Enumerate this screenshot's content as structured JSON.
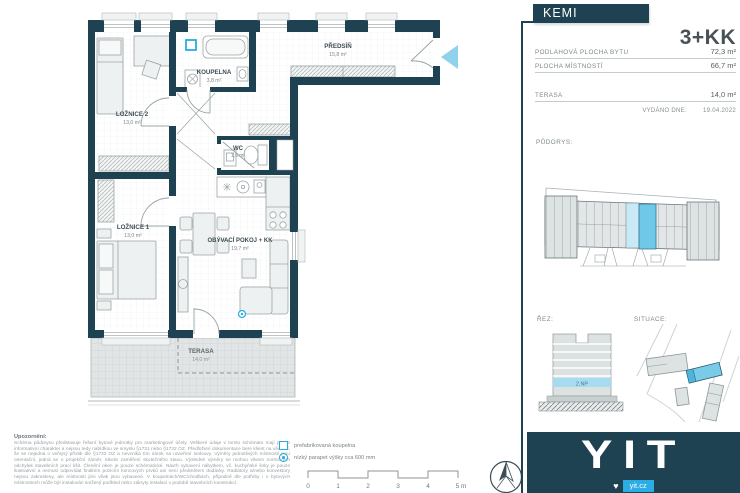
{
  "project": {
    "name": "KEMI",
    "unit_type": "3+KK"
  },
  "info": {
    "rows": [
      {
        "label": "PODLAHOVÁ PLOCHA BYTU",
        "value": "72,3 m²"
      },
      {
        "label": "PLOCHA MÍSTNOSTÍ",
        "value": "66,7 m²"
      },
      {
        "label": "TERASA",
        "value": "14,0 m²"
      }
    ],
    "issued_label": "VYDÁNO DNE:",
    "issued_date": "19.04.2022"
  },
  "section_labels": {
    "floorplan": "PŮDORYS:",
    "cut": "ŘEZ:",
    "situation": "SITUACE:"
  },
  "building": {
    "floor_badge": "2.NP"
  },
  "rooms": [
    {
      "name": "LOŽNICE 2",
      "area": "13,0 m²"
    },
    {
      "name": "KOUPELNA",
      "area": "3,8 m²"
    },
    {
      "name": "PŘEDSÍŇ",
      "area": "15,8 m²"
    },
    {
      "name": "WC",
      "area": "1,6 m²"
    },
    {
      "name": "LOŽNICE 1",
      "area": "13,0 m²"
    },
    {
      "name": "OBÝVACÍ POKOJ + KK",
      "area": "19,7 m²"
    },
    {
      "name": "TERASA",
      "area": "14,0 m²"
    }
  ],
  "legend": {
    "items": [
      {
        "label": "prefabrikovaná koupelna"
      },
      {
        "label": "nízký parapet výšky cca 600 mm"
      }
    ]
  },
  "scale_bar": {
    "ticks": [
      "0",
      "1",
      "2",
      "3",
      "4",
      "5 m"
    ]
  },
  "disclaimer": {
    "title": "Upozornění:",
    "body": "Schéma půdorysu představuje řešení bytové jednotky pro marketingové účely. Veškeré údaje v tomto schématu mají pouze informativní charakter a nejsou tedy nabídkou ve smyslu §1731 nebo §1732 OZ. Předložení dokumentace bere klient na vědomí, že se nejedná o veřejný příslib dle §1733 OZ a nevzniká tím nárok na uzavření smlouvy. Výměry jednotlivých místností jsou orientační, jedná se o projekční záměr, nikoliv zaměření skutečného stavu. Výsledné výměry se mohou vlivem normových odchylek stavebních prací lišit. Členění oken je pouze schématické. Návrh vybavení nábytkem, vč. kuchyňské linky je pouze ilustrativní a nemusí odpovídat finálním pozicím koncových prvků ani není předmětem dodávky. Radiátory a/nebo konvektory nejsou zakresleny, ale místnosti jimi však jsou vybavené. V koupelnách/WC/chodbách, případně dle potřeby i v bytových místnostech může být instalován snížený podhled nebo zákryty instalací v podobě stavebních konstrukcí."
  },
  "brand": {
    "logo": "YIT",
    "website": "yit.cz"
  },
  "icons": {
    "heart": "♥"
  },
  "colors": {
    "wall_teal": "#1e4251",
    "accent_blue": "#29ace2",
    "entrance_arrow": "#8ed2ec",
    "unit_highlight": "#6fc8e8",
    "badge_blue": "#2bace2"
  }
}
